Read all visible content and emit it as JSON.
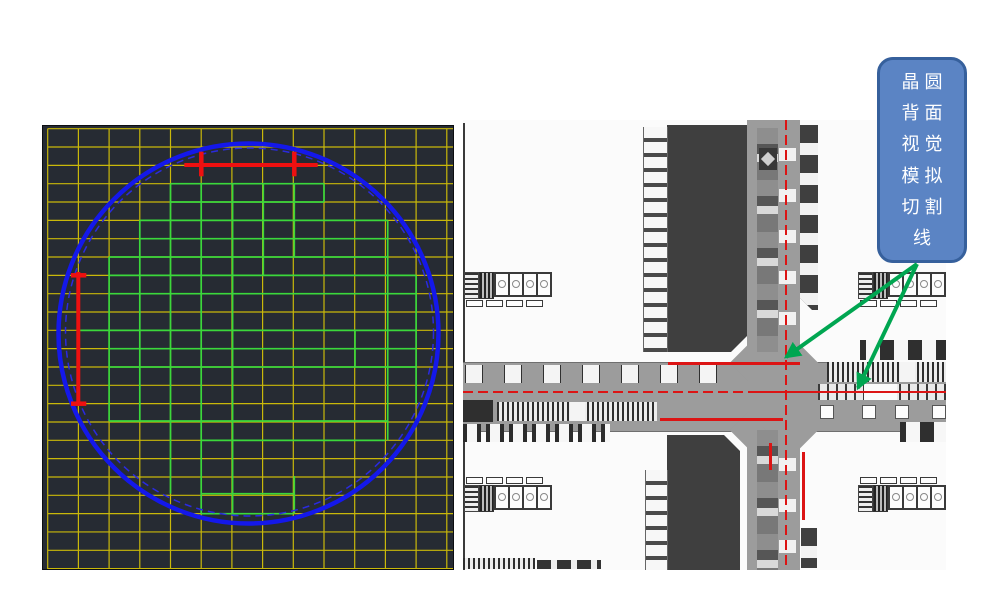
{
  "figure": {
    "callout": {
      "lines": [
        "晶圆",
        "背面",
        "视觉",
        "模拟",
        "切割",
        "线"
      ],
      "fill": "#5b84c4",
      "border_color": "#36609c",
      "text_color": "#ffffff"
    },
    "arrows": {
      "color": "#00a651",
      "origin": {
        "x": 917,
        "y": 264
      },
      "targets": [
        {
          "x": 786,
          "y": 357
        },
        {
          "x": 858,
          "y": 388
        }
      ]
    },
    "wafer_map": {
      "bg": "#262b33",
      "grid": {
        "color": "#c9b80a",
        "col_start": 4.7,
        "col_step": 30.7,
        "col_count": 14,
        "row_start": 2.7,
        "row_step": 18.33,
        "row_count": 25,
        "width": 410,
        "height": 443
      },
      "wafer_circle": {
        "solid": {
          "cx": 205.5,
          "cy": 207.5,
          "r": 190,
          "color": "#1418ea",
          "width": 4.5
        },
        "dashed": {
          "cx": 206.5,
          "cy": 206,
          "r": 184,
          "color": "#2a2ae0",
          "width": 1.5,
          "dash": "7 5"
        }
      },
      "die_map_color": "#3bd83b",
      "die_map_h_segments": [
        [
          57.7,
          127.5,
          281
        ],
        [
          76,
          127.5,
          281
        ],
        [
          94.4,
          96.8,
          344.7
        ],
        [
          112.7,
          96.8,
          344.7
        ],
        [
          131,
          66.1,
          344.7
        ],
        [
          149.4,
          66.1,
          373.1
        ],
        [
          167.7,
          66.1,
          373.1
        ],
        [
          204.4,
          35.4,
          373.1
        ],
        [
          222.7,
          66.1,
          373.1
        ],
        [
          241,
          66.1,
          373.1
        ],
        [
          295,
          66.1,
          344.7
        ],
        [
          314.4,
          158.2,
          342.4
        ],
        [
          367.7,
          158.2,
          250.3
        ],
        [
          387.7,
          158.2,
          250.3
        ]
      ],
      "die_map_v_segments": [
        [
          127.5,
          57.7,
          367.7
        ],
        [
          96.8,
          94.4,
          295
        ],
        [
          66.1,
          131,
          295
        ],
        [
          158.2,
          57.7,
          387.7
        ],
        [
          189.6,
          57.7,
          387.7
        ],
        [
          220.3,
          57.7,
          149.4
        ],
        [
          251.3,
          57.7,
          131
        ],
        [
          251.3,
          350,
          387.7
        ],
        [
          281,
          57.7,
          76
        ],
        [
          312,
          204.4,
          241
        ],
        [
          344.7,
          94.4,
          314.4
        ],
        [
          373.1,
          149.4,
          277.7
        ]
      ],
      "cut_marks": {
        "color": "#ee1010",
        "horizontal": {
          "y": 39,
          "x1": 141.3,
          "x2": 274.7,
          "tick_xs": [
            158.3,
            251.3
          ],
          "tick_y1": 25.7,
          "tick_y2": 50.3
        },
        "vertical": {
          "x": 35.3,
          "y1": 146,
          "y2": 279,
          "tick_ys": [
            149.3,
            277.7
          ],
          "tick_x1": 28,
          "tick_x2": 43.3
        }
      }
    },
    "photo": {
      "red": "#dc1414",
      "street_color": "#9c9c9c",
      "die_color": "#3f3f3f"
    }
  }
}
